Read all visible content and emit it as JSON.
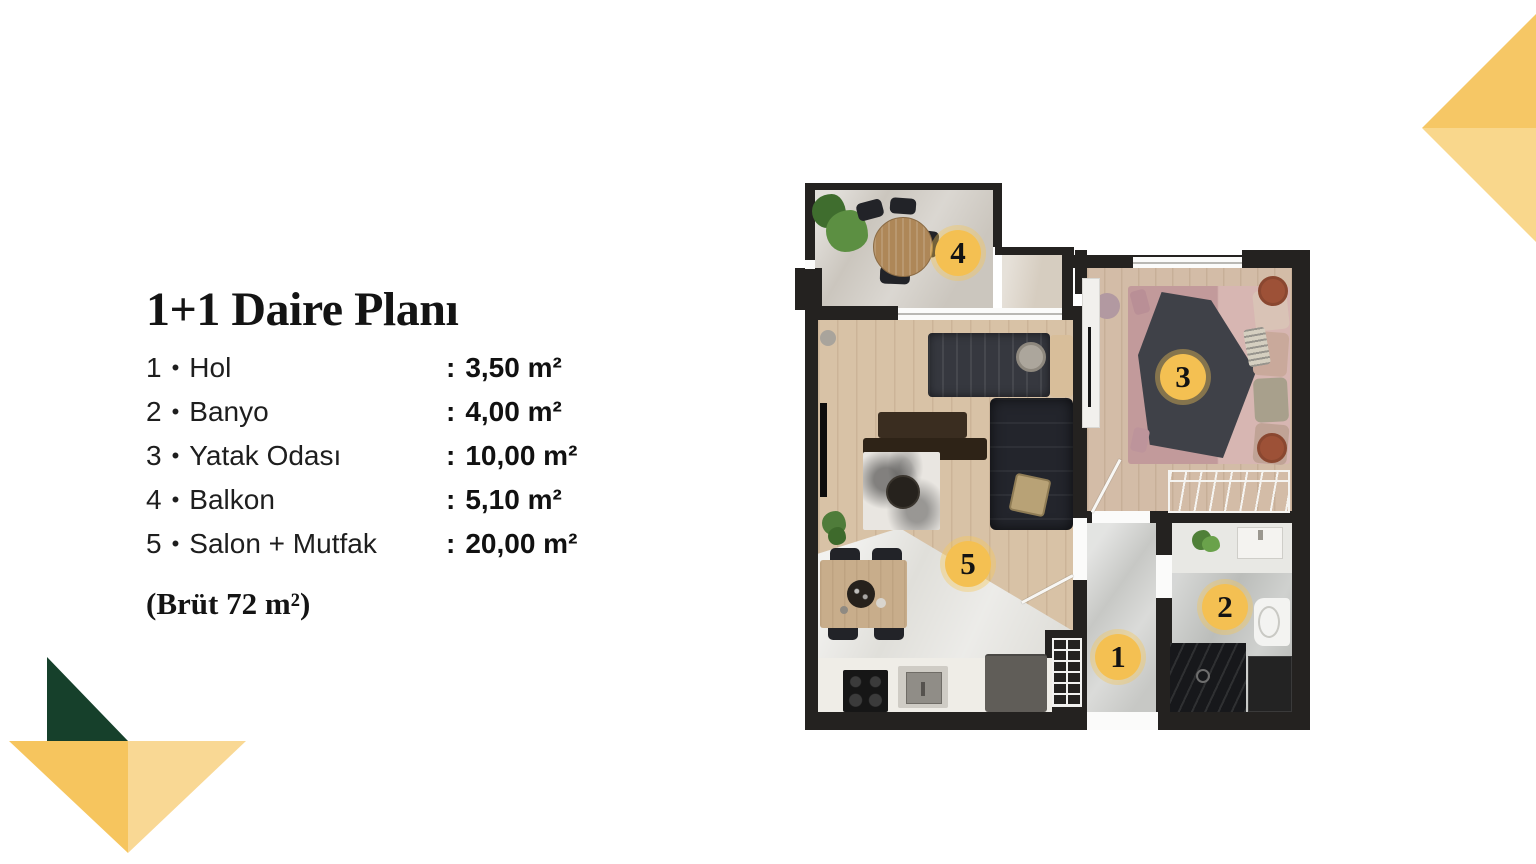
{
  "header": {
    "title": "1+1 Daire Planı"
  },
  "legend": {
    "bullet": "•",
    "colon": ":",
    "rooms": [
      {
        "num": "1",
        "name": "Hol",
        "area": "3,50 m²"
      },
      {
        "num": "2",
        "name": "Banyo",
        "area": "4,00 m²"
      },
      {
        "num": "3",
        "name": "Yatak Odası",
        "area": "10,00 m²"
      },
      {
        "num": "4",
        "name": "Balkon",
        "area": "5,10 m²"
      },
      {
        "num": "5",
        "name": "Salon + Mutfak",
        "area": "20,00 m²"
      }
    ],
    "gross_area": "(Brüt 72 m²)"
  },
  "palette": {
    "marker_gold": "#F4C052",
    "wall": "#242220",
    "triangle_gold_dark": "#F6C765",
    "triangle_gold_light": "#F9D78C",
    "triangle_green": "#16402B"
  }
}
